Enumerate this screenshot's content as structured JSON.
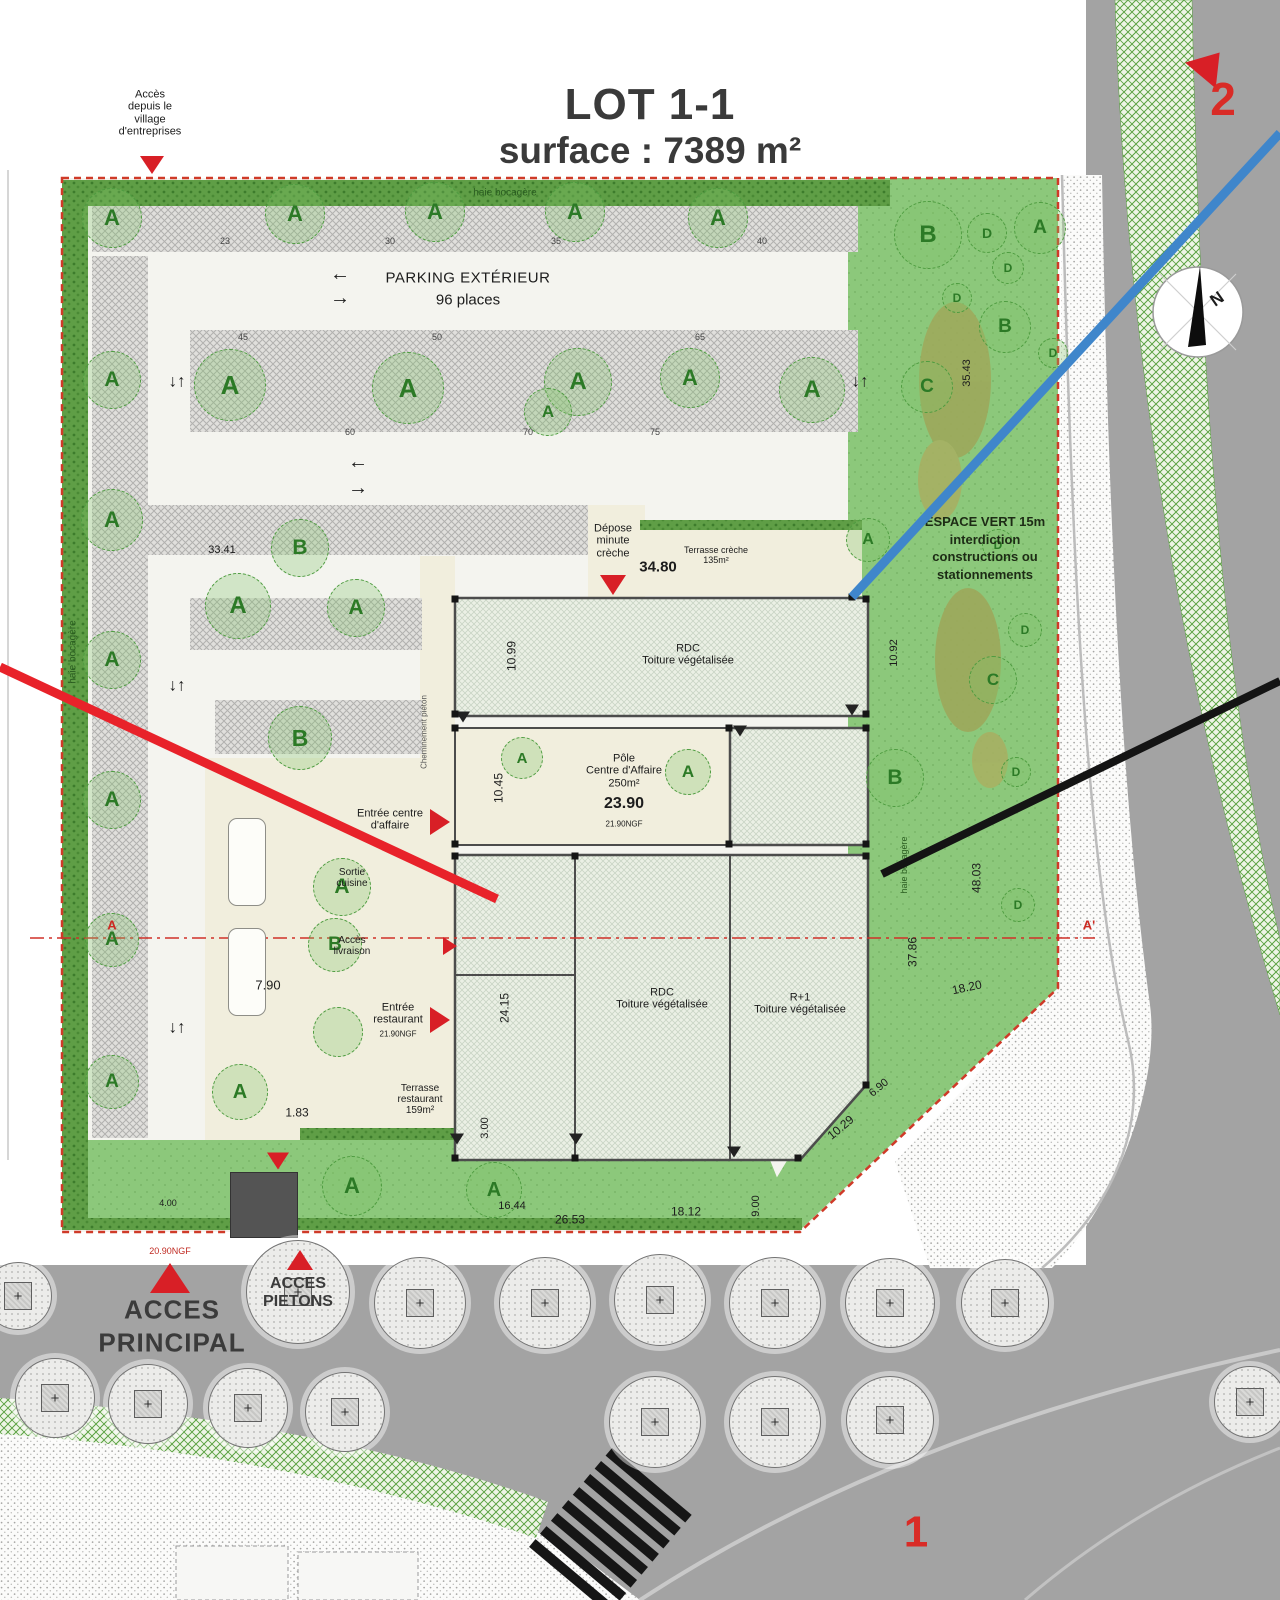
{
  "title": {
    "line1": "LOT 1-1",
    "line2": "surface : 7389 m²"
  },
  "colors": {
    "annotation_red": "#e8222a",
    "annotation_blue": "#3f86cb",
    "annotation_black": "#141414",
    "boundary_red": "#cf3a28",
    "hedge_green": "#5f9e46",
    "lawn_green": "#8cc87b",
    "road_gray": "#a3a3a3",
    "marker_red": "#d81f26"
  },
  "labels": [
    {
      "n": "hedge-label-top",
      "t": "haie bocagère",
      "x": 505,
      "y": 193,
      "s": 10,
      "c": "#2a5c20"
    },
    {
      "n": "hedge-label-left",
      "t": "haie bocagère",
      "x": 73,
      "y": 652,
      "s": 10,
      "c": "#2a5c20",
      "r": -90
    },
    {
      "n": "hedge-label-right",
      "t": "haie bocagère",
      "x": 904,
      "y": 865,
      "s": 9,
      "c": "#2a5c20",
      "r": -90
    },
    {
      "n": "access-village-label",
      "t": "Accès\ndepuis le\nvillage\nd'entreprises",
      "x": 150,
      "y": 113,
      "s": 11
    },
    {
      "n": "parking-title",
      "t": "PARKING EXTÉRIEUR",
      "x": 468,
      "y": 279,
      "s": 15,
      "ls": 0.5
    },
    {
      "n": "parking-places",
      "t": "96 places",
      "x": 468,
      "y": 301,
      "s": 15
    },
    {
      "n": "espace-vert-note",
      "t": "ESPACE VERT 15m\ninterdiction\nconstructions ou\nstationnements",
      "x": 985,
      "y": 548,
      "s": 13,
      "b": 1,
      "c": "#1d2b15",
      "lh": 1.35
    },
    {
      "n": "depose-minute-label",
      "t": "Dépose\nminute\ncrèche",
      "x": 613,
      "y": 541,
      "s": 11
    },
    {
      "n": "dim-34-80",
      "t": "34.80",
      "x": 658,
      "y": 568,
      "s": 15,
      "b": 1
    },
    {
      "n": "terrasse-creche-label",
      "t": "Terrasse crèche\n135m²",
      "x": 716,
      "y": 555,
      "s": 9
    },
    {
      "n": "rdc-creche-label",
      "t": "RDC\nToiture végétalisée",
      "x": 688,
      "y": 655,
      "s": 11
    },
    {
      "n": "pole-centre-affaire-label",
      "t": "Pôle\nCentre d'Affaire\n250m²",
      "x": 624,
      "y": 771,
      "s": 11
    },
    {
      "n": "dim-23-90",
      "t": "23.90",
      "x": 624,
      "y": 804,
      "s": 16,
      "b": 1
    },
    {
      "n": "ngf-centre",
      "t": "21.90NGF",
      "x": 624,
      "y": 825,
      "s": 8
    },
    {
      "n": "entree-centre-label",
      "t": "Entrée centre\nd'affaire",
      "x": 390,
      "y": 820,
      "s": 11
    },
    {
      "n": "sortie-cuisine-label",
      "t": "Sortie\ncuisine",
      "x": 352,
      "y": 878,
      "s": 10
    },
    {
      "n": "acces-livraison-label",
      "t": "Accès\nlivraison",
      "x": 352,
      "y": 946,
      "s": 10
    },
    {
      "n": "entree-restaurant-label",
      "t": "Entrée\nrestaurant",
      "x": 398,
      "y": 1014,
      "s": 11
    },
    {
      "n": "ngf-restaurant",
      "t": "21.90NGF",
      "x": 398,
      "y": 1035,
      "s": 8
    },
    {
      "n": "terrasse-restaurant-label",
      "t": "Terrasse\nrestaurant\n159m²",
      "x": 420,
      "y": 1100,
      "s": 10
    },
    {
      "n": "rdc-main-label",
      "t": "RDC\nToiture végétalisée",
      "x": 662,
      "y": 999,
      "s": 11
    },
    {
      "n": "r1-main-label",
      "t": "R+1\nToiture végétalisée",
      "x": 800,
      "y": 1004,
      "s": 11
    },
    {
      "n": "acces-principal-label",
      "t": "ACCES\nPRINCIPAL",
      "x": 172,
      "y": 1326,
      "s": 26,
      "b": 1,
      "c": "#3b3b3b",
      "ls": 1,
      "lh": 1.25
    },
    {
      "n": "acces-pietons-label",
      "t": "ACCES\nPIETONS",
      "x": 298,
      "y": 1293,
      "s": 16,
      "b": 1,
      "c": "#3b3b3b"
    },
    {
      "n": "ngf-acces",
      "t": "20.90NGF",
      "x": 170,
      "y": 1251,
      "s": 9,
      "c": "#c02a22"
    },
    {
      "n": "zone-marker-2",
      "t": "2",
      "x": 1223,
      "y": 100,
      "s": 46,
      "b": 1,
      "c": "#d92b26"
    },
    {
      "n": "zone-marker-1",
      "t": "1",
      "x": 916,
      "y": 1532,
      "s": 44,
      "b": 1,
      "c": "#d92b26"
    },
    {
      "n": "compass-n",
      "t": "N",
      "x": 1217,
      "y": 299,
      "s": 17,
      "b": 1,
      "r": -35
    },
    {
      "n": "section-a",
      "t": "A",
      "x": 112,
      "y": 926,
      "s": 13,
      "b": 1,
      "c": "#cc2a22"
    },
    {
      "n": "section-a-prime",
      "t": "A'",
      "x": 1089,
      "y": 926,
      "s": 13,
      "b": 1,
      "c": "#cc2a22"
    },
    {
      "n": "dim",
      "t": "33.41",
      "x": 222,
      "y": 550,
      "s": 11
    },
    {
      "n": "dim",
      "t": "10.99",
      "x": 512,
      "y": 656,
      "s": 12,
      "r": -90
    },
    {
      "n": "dim",
      "t": "10.45",
      "x": 499,
      "y": 788,
      "s": 12,
      "r": -90
    },
    {
      "n": "dim",
      "t": "24.15",
      "x": 505,
      "y": 1008,
      "s": 12,
      "r": -90
    },
    {
      "n": "dim",
      "t": "7.90",
      "x": 268,
      "y": 986,
      "s": 13
    },
    {
      "n": "dim",
      "t": "1.83",
      "x": 297,
      "y": 1113,
      "s": 12
    },
    {
      "n": "dim",
      "t": "3.00",
      "x": 485,
      "y": 1128,
      "s": 11,
      "r": -90
    },
    {
      "n": "dim",
      "t": "16.44",
      "x": 512,
      "y": 1206,
      "s": 11
    },
    {
      "n": "dim",
      "t": "26.53",
      "x": 570,
      "y": 1220,
      "s": 12
    },
    {
      "n": "dim",
      "t": "18.12",
      "x": 686,
      "y": 1212,
      "s": 12
    },
    {
      "n": "dim",
      "t": "9.00",
      "x": 756,
      "y": 1206,
      "s": 11,
      "r": -90
    },
    {
      "n": "dim",
      "t": "10.29",
      "x": 841,
      "y": 1128,
      "s": 12,
      "r": -40
    },
    {
      "n": "dim",
      "t": "6.90",
      "x": 879,
      "y": 1088,
      "s": 11,
      "r": -40
    },
    {
      "n": "dim",
      "t": "18.20",
      "x": 967,
      "y": 988,
      "s": 12,
      "r": -12
    },
    {
      "n": "dim",
      "t": "37.86",
      "x": 913,
      "y": 952,
      "s": 12,
      "r": -90
    },
    {
      "n": "dim",
      "t": "48.03",
      "x": 977,
      "y": 878,
      "s": 12,
      "r": -90
    },
    {
      "n": "dim",
      "t": "10.92",
      "x": 894,
      "y": 653,
      "s": 11,
      "r": -90
    },
    {
      "n": "dim",
      "t": "35.43",
      "x": 967,
      "y": 373,
      "s": 11,
      "r": -90
    },
    {
      "n": "dim",
      "t": "4.00",
      "x": 168,
      "y": 1203,
      "s": 9
    },
    {
      "n": "stall-count",
      "t": "23",
      "x": 225,
      "y": 241,
      "s": 9,
      "c": "#444"
    },
    {
      "n": "stall-count",
      "t": "30",
      "x": 390,
      "y": 241,
      "s": 9,
      "c": "#444"
    },
    {
      "n": "stall-count",
      "t": "35",
      "x": 556,
      "y": 241,
      "s": 9,
      "c": "#444"
    },
    {
      "n": "stall-count",
      "t": "40",
      "x": 762,
      "y": 241,
      "s": 9,
      "c": "#444"
    },
    {
      "n": "stall-count",
      "t": "45",
      "x": 243,
      "y": 337,
      "s": 9,
      "c": "#444"
    },
    {
      "n": "stall-count",
      "t": "50",
      "x": 437,
      "y": 337,
      "s": 9,
      "c": "#444"
    },
    {
      "n": "stall-count",
      "t": "65",
      "x": 700,
      "y": 337,
      "s": 9,
      "c": "#444"
    },
    {
      "n": "stall-count",
      "t": "60",
      "x": 350,
      "y": 432,
      "s": 9,
      "c": "#444"
    },
    {
      "n": "stall-count",
      "t": "70",
      "x": 528,
      "y": 432,
      "s": 9,
      "c": "#444"
    },
    {
      "n": "stall-count",
      "t": "75",
      "x": 655,
      "y": 432,
      "s": 9,
      "c": "#444"
    },
    {
      "n": "cheminement-label",
      "t": "Cheminement piéton",
      "x": 425,
      "y": 732,
      "s": 8,
      "c": "#555",
      "r": -90
    },
    {
      "n": "flow-arrow",
      "t": "←",
      "x": 340,
      "y": 274,
      "s": 20,
      "b": 1
    },
    {
      "n": "flow-arrow",
      "t": "→",
      "x": 340,
      "y": 298,
      "s": 20,
      "b": 1
    },
    {
      "n": "flow-arrow",
      "t": "←",
      "x": 358,
      "y": 462,
      "s": 20,
      "b": 1
    },
    {
      "n": "flow-arrow",
      "t": "→",
      "x": 358,
      "y": 488,
      "s": 20,
      "b": 1
    },
    {
      "n": "flow-arrow",
      "t": "↓↑",
      "x": 177,
      "y": 381,
      "s": 17,
      "b": 1
    },
    {
      "n": "flow-arrow",
      "t": "↓↑",
      "x": 860,
      "y": 381,
      "s": 17,
      "b": 1
    },
    {
      "n": "flow-arrow",
      "t": "↓↑",
      "x": 177,
      "y": 685,
      "s": 17,
      "b": 1
    },
    {
      "n": "flow-arrow",
      "t": "↓↑",
      "x": 177,
      "y": 1027,
      "s": 17,
      "b": 1
    }
  ],
  "trees_green": [
    {
      "x": 112,
      "y": 218,
      "r": 30,
      "l": "A"
    },
    {
      "x": 295,
      "y": 214,
      "r": 30,
      "l": "A"
    },
    {
      "x": 435,
      "y": 212,
      "r": 30,
      "l": "A"
    },
    {
      "x": 575,
      "y": 212,
      "r": 30,
      "l": "A"
    },
    {
      "x": 718,
      "y": 218,
      "r": 30,
      "l": "A"
    },
    {
      "x": 1040,
      "y": 228,
      "r": 26,
      "l": "A"
    },
    {
      "x": 928,
      "y": 235,
      "r": 34,
      "l": "B"
    },
    {
      "x": 987,
      "y": 233,
      "r": 20,
      "l": "D"
    },
    {
      "x": 1008,
      "y": 268,
      "r": 16,
      "l": "D"
    },
    {
      "x": 957,
      "y": 298,
      "r": 15,
      "l": "D"
    },
    {
      "x": 1005,
      "y": 327,
      "r": 26,
      "l": "B"
    },
    {
      "x": 927,
      "y": 387,
      "r": 26,
      "l": "C"
    },
    {
      "x": 1053,
      "y": 353,
      "r": 15,
      "l": "D"
    },
    {
      "x": 230,
      "y": 385,
      "r": 36,
      "l": "A"
    },
    {
      "x": 408,
      "y": 388,
      "r": 36,
      "l": "A"
    },
    {
      "x": 578,
      "y": 382,
      "r": 34,
      "l": "A"
    },
    {
      "x": 690,
      "y": 378,
      "r": 30,
      "l": "A"
    },
    {
      "x": 812,
      "y": 390,
      "r": 33,
      "l": "A"
    },
    {
      "x": 548,
      "y": 412,
      "r": 24,
      "l": "A"
    },
    {
      "x": 112,
      "y": 380,
      "r": 29,
      "l": "A"
    },
    {
      "x": 112,
      "y": 520,
      "r": 31,
      "l": "A"
    },
    {
      "x": 112,
      "y": 660,
      "r": 29,
      "l": "A"
    },
    {
      "x": 112,
      "y": 800,
      "r": 29,
      "l": "A"
    },
    {
      "x": 112,
      "y": 940,
      "r": 27,
      "l": "A"
    },
    {
      "x": 112,
      "y": 1082,
      "r": 27,
      "l": "A"
    },
    {
      "x": 238,
      "y": 606,
      "r": 33,
      "l": "A"
    },
    {
      "x": 356,
      "y": 608,
      "r": 29,
      "l": "A"
    },
    {
      "x": 300,
      "y": 548,
      "r": 29,
      "l": "B"
    },
    {
      "x": 300,
      "y": 738,
      "r": 32,
      "l": "B"
    },
    {
      "x": 522,
      "y": 758,
      "r": 21,
      "l": "A"
    },
    {
      "x": 688,
      "y": 772,
      "r": 23,
      "l": "A"
    },
    {
      "x": 342,
      "y": 887,
      "r": 29,
      "l": "A"
    },
    {
      "x": 335,
      "y": 945,
      "r": 27,
      "l": "B"
    },
    {
      "x": 338,
      "y": 1032,
      "r": 25,
      "l": ""
    },
    {
      "x": 868,
      "y": 540,
      "r": 22,
      "l": "A"
    },
    {
      "x": 998,
      "y": 545,
      "r": 16,
      "l": "D"
    },
    {
      "x": 1025,
      "y": 630,
      "r": 17,
      "l": "D"
    },
    {
      "x": 993,
      "y": 680,
      "r": 24,
      "l": "C"
    },
    {
      "x": 895,
      "y": 778,
      "r": 29,
      "l": "B"
    },
    {
      "x": 1016,
      "y": 772,
      "r": 15,
      "l": "D"
    },
    {
      "x": 1018,
      "y": 905,
      "r": 17,
      "l": "D"
    },
    {
      "x": 240,
      "y": 1092,
      "r": 28,
      "l": "A"
    },
    {
      "x": 352,
      "y": 1186,
      "r": 30,
      "l": "A"
    },
    {
      "x": 494,
      "y": 1190,
      "r": 28,
      "l": "A"
    }
  ],
  "trees_gray": [
    {
      "x": 420,
      "y": 1303,
      "r": 46
    },
    {
      "x": 545,
      "y": 1303,
      "r": 46
    },
    {
      "x": 660,
      "y": 1300,
      "r": 46
    },
    {
      "x": 775,
      "y": 1303,
      "r": 46
    },
    {
      "x": 890,
      "y": 1303,
      "r": 45
    },
    {
      "x": 1005,
      "y": 1303,
      "r": 44
    },
    {
      "x": 655,
      "y": 1422,
      "r": 46
    },
    {
      "x": 775,
      "y": 1422,
      "r": 46
    },
    {
      "x": 890,
      "y": 1420,
      "r": 44
    },
    {
      "x": 298,
      "y": 1292,
      "r": 52
    },
    {
      "x": 55,
      "y": 1398,
      "r": 40
    },
    {
      "x": 148,
      "y": 1404,
      "r": 40
    },
    {
      "x": 248,
      "y": 1408,
      "r": 40
    },
    {
      "x": 345,
      "y": 1412,
      "r": 40
    },
    {
      "x": 18,
      "y": 1296,
      "r": 34
    },
    {
      "x": 1250,
      "y": 1402,
      "r": 36
    }
  ],
  "markers": [
    {
      "n": "access-village-arrow",
      "t": "down",
      "x": 152,
      "y": 165,
      "s": 12
    },
    {
      "n": "depose-arrow",
      "t": "down",
      "x": 613,
      "y": 585,
      "s": 13
    },
    {
      "n": "entree-centre-arrow",
      "t": "right",
      "x": 440,
      "y": 822,
      "s": 13
    },
    {
      "n": "livraison-arrow",
      "t": "right",
      "x": 450,
      "y": 946,
      "s": 9
    },
    {
      "n": "entree-restaurant-arrow",
      "t": "right",
      "x": 440,
      "y": 1020,
      "s": 13
    },
    {
      "n": "south-access-arrow",
      "t": "down",
      "x": 278,
      "y": 1161,
      "s": 11
    },
    {
      "n": "acces-principal-arrow",
      "t": "up",
      "x": 170,
      "y": 1278,
      "s": 20
    },
    {
      "n": "acces-pietons-arrow",
      "t": "up",
      "x": 300,
      "y": 1260,
      "s": 13
    },
    {
      "n": "zone-2-arrow",
      "t": "up",
      "x": 1210,
      "y": 64,
      "s": 20,
      "r": 40
    },
    {
      "t": "down",
      "x": 463,
      "y": 717,
      "s": 7,
      "c": "#222"
    },
    {
      "t": "down",
      "x": 852,
      "y": 710,
      "s": 7,
      "c": "#222"
    },
    {
      "t": "down",
      "x": 740,
      "y": 731,
      "s": 7,
      "c": "#222"
    },
    {
      "t": "down",
      "x": 457,
      "y": 1139,
      "s": 7,
      "c": "#222"
    },
    {
      "t": "down",
      "x": 576,
      "y": 1139,
      "s": 7,
      "c": "#222"
    },
    {
      "t": "down",
      "x": 734,
      "y": 1152,
      "s": 7,
      "c": "#222"
    },
    {
      "t": "sq",
      "x": 455,
      "y": 599
    },
    {
      "t": "sq",
      "x": 866,
      "y": 599
    },
    {
      "t": "sq",
      "x": 455,
      "y": 714
    },
    {
      "t": "sq",
      "x": 866,
      "y": 714
    },
    {
      "t": "sq",
      "x": 455,
      "y": 728
    },
    {
      "t": "sq",
      "x": 729,
      "y": 728
    },
    {
      "t": "sq",
      "x": 866,
      "y": 728
    },
    {
      "t": "sq",
      "x": 455,
      "y": 844
    },
    {
      "t": "sq",
      "x": 729,
      "y": 844
    },
    {
      "t": "sq",
      "x": 866,
      "y": 844
    },
    {
      "t": "sq",
      "x": 455,
      "y": 856
    },
    {
      "t": "sq",
      "x": 575,
      "y": 856
    },
    {
      "t": "sq",
      "x": 866,
      "y": 856
    },
    {
      "t": "sq",
      "x": 455,
      "y": 1158
    },
    {
      "t": "sq",
      "x": 575,
      "y": 1158
    },
    {
      "t": "sq",
      "x": 798,
      "y": 1158
    },
    {
      "t": "sq",
      "x": 866,
      "y": 1085
    },
    {
      "t": "sq",
      "x": 852,
      "y": 597
    }
  ]
}
